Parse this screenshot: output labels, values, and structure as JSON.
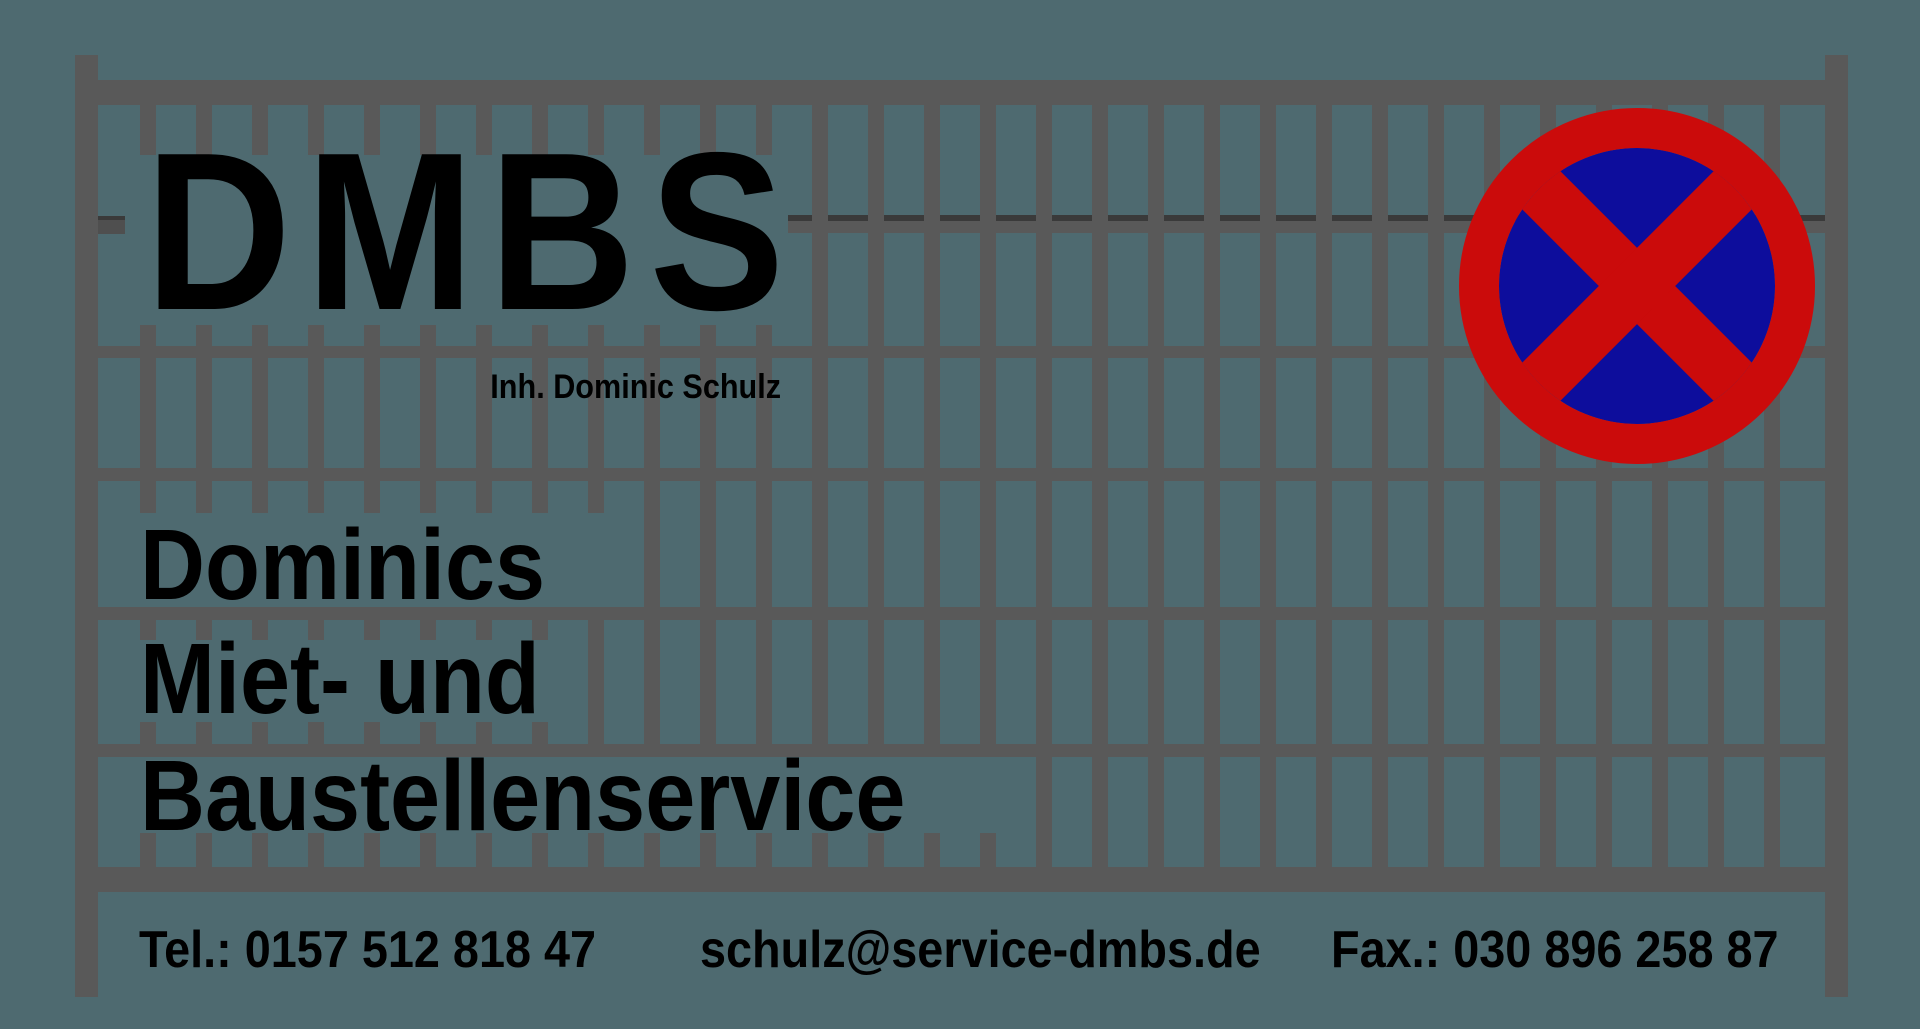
{
  "page": {
    "title": "DMBS - Dominics Miet- und Baustellenservice"
  },
  "colors": {
    "bg": "#4E6A70",
    "fence": "#595959",
    "shadow": "#3A3A3A",
    "bracket": "#4F4F4F",
    "text": "#000000",
    "red": "#CB0B0B",
    "blue": "#0D0D9C"
  },
  "logo": {
    "brand": "DMBS",
    "owner": "Inh. Dominic Schulz",
    "lines": [
      "Dominics",
      "Miet- und",
      "Baustellenservice"
    ]
  },
  "contact": {
    "phone": "Tel.: 0157 512 818 47",
    "email": "schulz@service-dmbs.de",
    "fax": "Fax.: 030 896 258 87"
  },
  "sign": {
    "icon": "no-stopping-icon",
    "center": {
      "x": 1637,
      "y": 286
    },
    "outer_radius": 178,
    "ring_thickness": 40,
    "bar_thickness": 54
  },
  "fence": {
    "posts": [
      {
        "x": 75,
        "y": 55,
        "w": 23,
        "h": 942
      },
      {
        "x": 1825,
        "y": 55,
        "w": 23,
        "h": 942
      }
    ],
    "rails": [
      {
        "x": 75,
        "y": 80,
        "w": 1773,
        "h": 25
      },
      {
        "x": 788,
        "y": 221,
        "w": 1037,
        "h": 12
      },
      {
        "x": 98,
        "y": 346,
        "w": 1727,
        "h": 12
      },
      {
        "x": 98,
        "y": 468,
        "w": 1727,
        "h": 13
      },
      {
        "x": 98,
        "y": 607,
        "w": 1727,
        "h": 13
      },
      {
        "x": 98,
        "y": 744,
        "w": 1727,
        "h": 13
      },
      {
        "x": 75,
        "y": 867,
        "w": 1773,
        "h": 25
      }
    ],
    "shadow_line": {
      "x": 788,
      "y": 215,
      "w": 1037,
      "h": 6
    },
    "bracket": {
      "x": 98,
      "y": 216,
      "w": 27,
      "h": 18
    },
    "pickets": {
      "first_x": 140,
      "pitch": 56,
      "width": 16,
      "count": 30
    },
    "rows": [
      {
        "top": 105,
        "bottom": 233,
        "window": {
          "from": 0,
          "to": 11,
          "segments": [
            [
              105,
              155
            ]
          ]
        }
      },
      {
        "top": 233,
        "bottom": 358,
        "window": {
          "from": 0,
          "to": 11,
          "segments": [
            [
              325,
              358
            ]
          ]
        }
      },
      {
        "top": 358,
        "bottom": 481,
        "window": null
      },
      {
        "top": 481,
        "bottom": 620,
        "window": {
          "from": 0,
          "to": 8,
          "segments": [
            [
              481,
              513
            ]
          ]
        }
      },
      {
        "top": 620,
        "bottom": 757,
        "window": {
          "from": 0,
          "to": 7,
          "segments": [
            [
              620,
              640
            ],
            [
              722,
              757
            ]
          ]
        }
      },
      {
        "top": 757,
        "bottom": 892,
        "window": {
          "from": 0,
          "to": 15,
          "segments": [
            [
              833,
              892
            ]
          ]
        }
      }
    ]
  }
}
